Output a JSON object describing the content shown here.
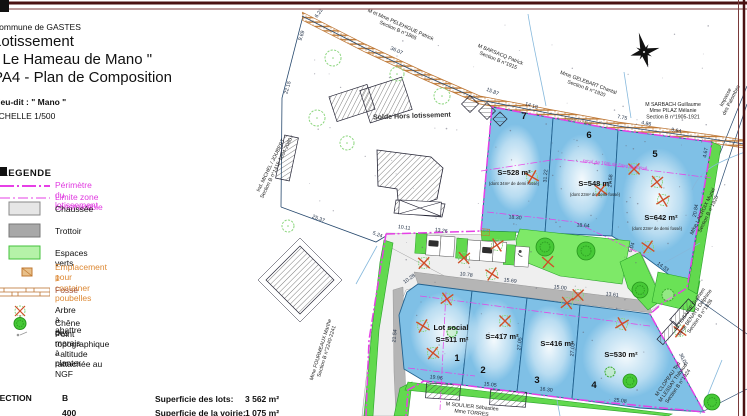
{
  "document": {
    "commune": "Commune de GASTES",
    "title1": "Lotissement",
    "title2": "\" Le Hameau de Mano \"",
    "title3": "PA4 - Plan de Composition",
    "lieu_dit": "Lieu-dit : \" Mano \"",
    "echelle": "ECHELLE 1/500"
  },
  "legend": {
    "title": "LEGENDE",
    "perimetre": "Périmètre du lotissement",
    "limite": "Limite zone constructible",
    "chaussee": "Chaussée",
    "trottoir": "Trottoir",
    "espaces_verts": "Espaces verts",
    "emplacement_1": "Emplacement pour",
    "emplacement_2": "1 container poubelles",
    "fosse": "Fossé",
    "arbre": "Arbre à abattre",
    "chene": "Chêne des marais à planter",
    "point_topo": "Point topographique - altitude rattachée au NGF",
    "magenta": "#e640e6",
    "orange": "#dd8833"
  },
  "summary": {
    "section_label": "SECTION",
    "section_value": "B",
    "row2_fragment": "400",
    "lots_label": "Superficie des lots:",
    "lots_value": "3 562 m²",
    "voirie_label": "Superficie de la voirie:",
    "voirie_value": "1 075 m²"
  },
  "map": {
    "solde_label": "Solde Hors lotissement",
    "recul_label": "recul de 10m de l'axe du fossé",
    "fosse_existant": "Fossé existant",
    "lots": [
      {
        "num": "7",
        "area": "S=528 m²",
        "note": "(dont 34m² de demi fossé)"
      },
      {
        "num": "6",
        "area": "S=548 m²",
        "note": "(dont 23m² de demi fossé)"
      },
      {
        "num": "5",
        "area": "S=642 m²",
        "note": "(dont 23m² de demi fossé)"
      },
      {
        "num": "1",
        "area": "S=511 m²",
        "name": "Lot social"
      },
      {
        "num": "2",
        "area": "S=417 m²"
      },
      {
        "num": "3",
        "area": "S=416 m²"
      },
      {
        "num": "4",
        "area": "S=530 m²"
      }
    ],
    "owners": [
      {
        "lines": [
          "M et Mme PELEHIGUE Patrick",
          "Section B n°1865"
        ],
        "x": 400,
        "y": 26,
        "r": 24
      },
      {
        "lines": [
          "M BARSACQ Patrick",
          "Section B n°1915"
        ],
        "x": 500,
        "y": 56,
        "r": 22
      },
      {
        "lines": [
          "Mme GELEBART Chantal",
          "Section B n°1920"
        ],
        "x": 588,
        "y": 84,
        "r": 20
      },
      {
        "lines": [
          "M SARBACH Guillaume",
          "Mme PILAZ Mélanie",
          "Section B n°1905-1921"
        ],
        "x": 673,
        "y": 106,
        "r": 0
      },
      {
        "lines": [
          "Impasse",
          "des Palombes"
        ],
        "x": 727,
        "y": 98,
        "r": -63,
        "s": 6.8
      },
      {
        "lines": [
          "Mme LACROIX Muriel",
          "Section B n°1926"
        ],
        "x": 704,
        "y": 212,
        "r": -64
      },
      {
        "lines": [
          "M TISSANIE Guilhem",
          "Mme BENAYS Delphine",
          "Section B n°1836"
        ],
        "x": 691,
        "y": 310,
        "r": -55
      },
      {
        "lines": [
          "M CLOPEAU Ted",
          "M LESSAY Thibaud",
          "Section B n°1924"
        ],
        "x": 669,
        "y": 380,
        "r": -55
      },
      {
        "lines": [
          "Mme FOURMEAUX Marthe",
          "Section B n°2240-2241"
        ],
        "x": 322,
        "y": 350,
        "r": -73
      },
      {
        "lines": [
          "Ind. MICHEL / JOUBERT",
          "Section B n°1415-1604-2080"
        ],
        "x": 272,
        "y": 166,
        "r": -64
      },
      {
        "lines": [
          "M SOULIER Sébastien",
          "Mme TORRES"
        ],
        "x": 472,
        "y": 408,
        "r": 6
      }
    ],
    "dimensions": [
      [
        "6.22",
        320,
        14,
        -55
      ],
      [
        "9.69",
        303,
        36,
        -72
      ],
      [
        "36.07",
        396,
        52,
        24
      ],
      [
        "15.87",
        492,
        93,
        22
      ],
      [
        "14.18",
        531,
        107,
        17
      ],
      [
        "7.75",
        622,
        119,
        11
      ],
      [
        "4.86",
        646,
        125,
        11
      ],
      [
        "9.64",
        676,
        132,
        11
      ],
      [
        "22.15",
        289,
        88,
        -74
      ],
      [
        "25.37",
        318,
        220,
        21
      ],
      [
        "5.24",
        377,
        236,
        21
      ],
      [
        "10.11",
        404,
        229,
        8
      ],
      [
        "13.26",
        441,
        232,
        8
      ],
      [
        "31.22",
        547,
        176,
        -86
      ],
      [
        "27.58",
        612,
        181,
        -86
      ],
      [
        "18.30",
        515,
        219,
        4
      ],
      [
        "18.64",
        583,
        227,
        4
      ],
      [
        "4.67",
        707,
        153,
        -80
      ],
      [
        "20.84",
        697,
        211,
        -80
      ],
      [
        "6.04",
        633,
        248,
        -70
      ],
      [
        "14.33",
        662,
        268,
        36
      ],
      [
        "10.28",
        410,
        280,
        -35
      ],
      [
        "10.78",
        466,
        276,
        7
      ],
      [
        "15.69",
        510,
        282,
        7
      ],
      [
        "15.00",
        560,
        289,
        7
      ],
      [
        "13.61",
        612,
        296,
        7
      ],
      [
        "21.54",
        396,
        336,
        -84
      ],
      [
        "27.05",
        521,
        344,
        -84
      ],
      [
        "27.03",
        574,
        350,
        -84
      ],
      [
        "30.05",
        682,
        360,
        64
      ],
      [
        "19.96",
        436,
        379,
        7
      ],
      [
        "15.05",
        490,
        386,
        7
      ],
      [
        "16.30",
        546,
        391,
        7
      ],
      [
        "25.08",
        620,
        402,
        7
      ]
    ]
  }
}
